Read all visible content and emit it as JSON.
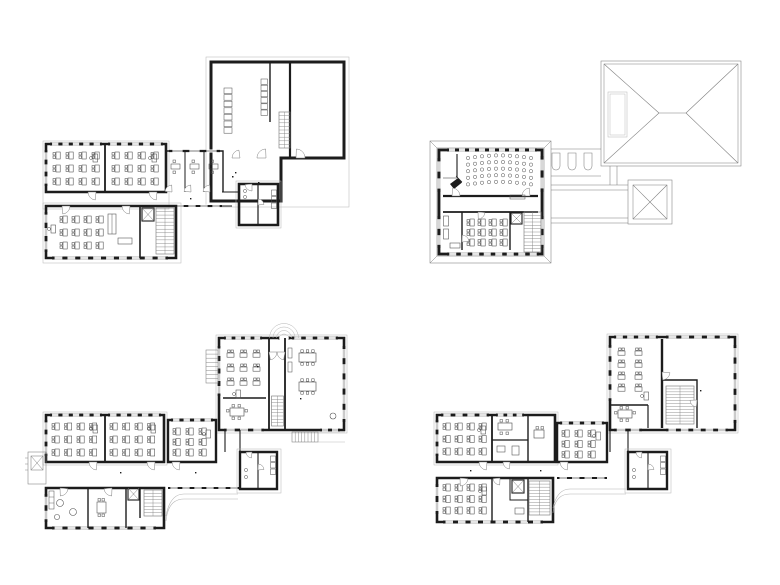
{
  "drawing": {
    "type": "architectural-floor-plan-set",
    "sheet_count": 4,
    "colors": {
      "paper": "#ffffff",
      "walls": "#1c1c1c",
      "thin_lines": "#7d7d7d",
      "faint_lines": "#b4b4b4",
      "furniture": "#4a4a4a"
    },
    "plans": [
      {
        "key": "plan_top_left",
        "position": "top-left",
        "description": "Floor plan with large assembly hall, lockers and stair, two classrooms with desk rows, three small offices, a lower classroom wing and WC block",
        "classroom_desk_grids": [
          {
            "cols": 4,
            "rows": 3
          },
          {
            "cols": 4,
            "rows": 3
          },
          {
            "cols": 4,
            "rows": 3
          }
        ]
      },
      {
        "key": "plan_top_right",
        "position": "top-right",
        "description": "Roof-level plan: auditorium with curved seating rows and grand piano, classroom, lounge and stair; hipped roof with dormer; pyramidal skylight roof; connecting walkway with roof slots",
        "auditorium_seating": {
          "rows": 5,
          "seats_per_row": 10
        },
        "roof": {
          "main": "hipped",
          "secondary": "pyramidal"
        }
      },
      {
        "key": "plan_bottom_left",
        "position": "bottom-left",
        "description": "Ground floor plan: entrance with fanlight, group room and classroom, hall with two long tables, three classrooms with desk rows, kitchen with round tables, stairs, WC block and exterior steps",
        "classroom_desk_grids": [
          {
            "cols": 4,
            "rows": 3
          },
          {
            "cols": 4,
            "rows": 3
          },
          {
            "cols": 3,
            "rows": 3
          },
          {
            "cols": 3,
            "rows": 3
          }
        ]
      },
      {
        "key": "plan_bottom_right",
        "position": "bottom-right",
        "description": "Upper floor plan: double-height hall void, classroom with paired desks, group rooms, three classrooms with desk rows, stairs, WC block and connecting corridor",
        "classroom_desk_grids": [
          {
            "cols": 2,
            "rows": 4
          },
          {
            "cols": 4,
            "rows": 3
          },
          {
            "cols": 3,
            "rows": 3
          },
          {
            "cols": 4,
            "rows": 3
          }
        ]
      }
    ]
  }
}
